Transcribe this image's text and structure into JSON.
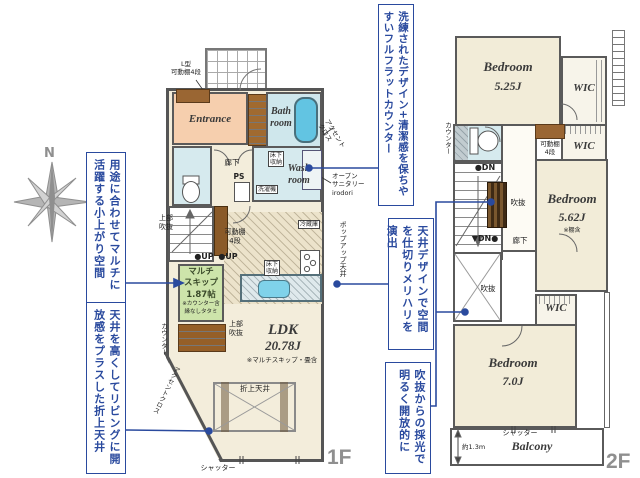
{
  "compass": {
    "north_label": "N"
  },
  "callouts": {
    "komagari": "用途に合わせてマルチに活躍する小上がり空間",
    "oriage": "天井を高くしてリビングに開放感をプラスした折上天井",
    "counter": "洗練されたデザイン+清潔感を保ちやすいフルフラットカウンター",
    "zoning": "天井デザインで空間を仕切りメリハリを演出",
    "saikou": "吹抜からの採光で明るく開放的に"
  },
  "floor1": {
    "floor_label": "1F",
    "entrance": "Entrance",
    "bath": "Bath\nroom",
    "wash": "Wash\nroom",
    "ldk_name": "LDK",
    "ldk_size": "20.78J",
    "ldk_note": "※マルチスキップ・畳含",
    "multi_name": "マルチ\nスキップ",
    "multi_size": "1.87帖",
    "multi_note1": "※カウンター含",
    "multi_note2": "縁なしタタミ",
    "l_shelf": "L型\n可動棚4段",
    "corridor": "廊下",
    "ps": "PS",
    "underfloor_wash": "床下\n収納",
    "washer": "洗濯機",
    "accent_cloth_top": "アクセント\nクロス",
    "open_sanitary": "オープン\nサニタリー\nirodori",
    "upper_void_stairs": "上部\n吹抜",
    "movable_shelf": "可動棚\n4段",
    "up1": "●UP",
    "up2": "●UP",
    "fridge": "冷蔵庫",
    "underfloor_kitchen": "床下\n収納",
    "popup_ceiling": "ポップアップ天井",
    "counter_label": "カウンター",
    "upper_void_ldk": "上部\n吹抜",
    "folded_ceiling": "折上天井",
    "accent_cloth_side": "アクセントクロス",
    "shutter": "シャッター"
  },
  "floor2": {
    "floor_label": "2F",
    "bed1_name": "Bedroom",
    "bed1_size": "5.25J",
    "bed2_name": "Bedroom",
    "bed2_size": "5.62J",
    "bed2_note": "※棚含",
    "bed3_name": "Bedroom",
    "bed3_size": "7.0J",
    "wic1": "WIC",
    "wic2": "WIC",
    "wic3": "WIC",
    "balcony": "Balcony",
    "balcony_depth": "約1.3m",
    "counter_label": "カウンター",
    "movable_shelf": "可動棚\n4段",
    "dn1": "●DN",
    "dn2": "▼DN●",
    "void_stairs": "吹抜",
    "void_open": "吹抜",
    "corridor": "廊下",
    "shutter": "シャッター"
  }
}
